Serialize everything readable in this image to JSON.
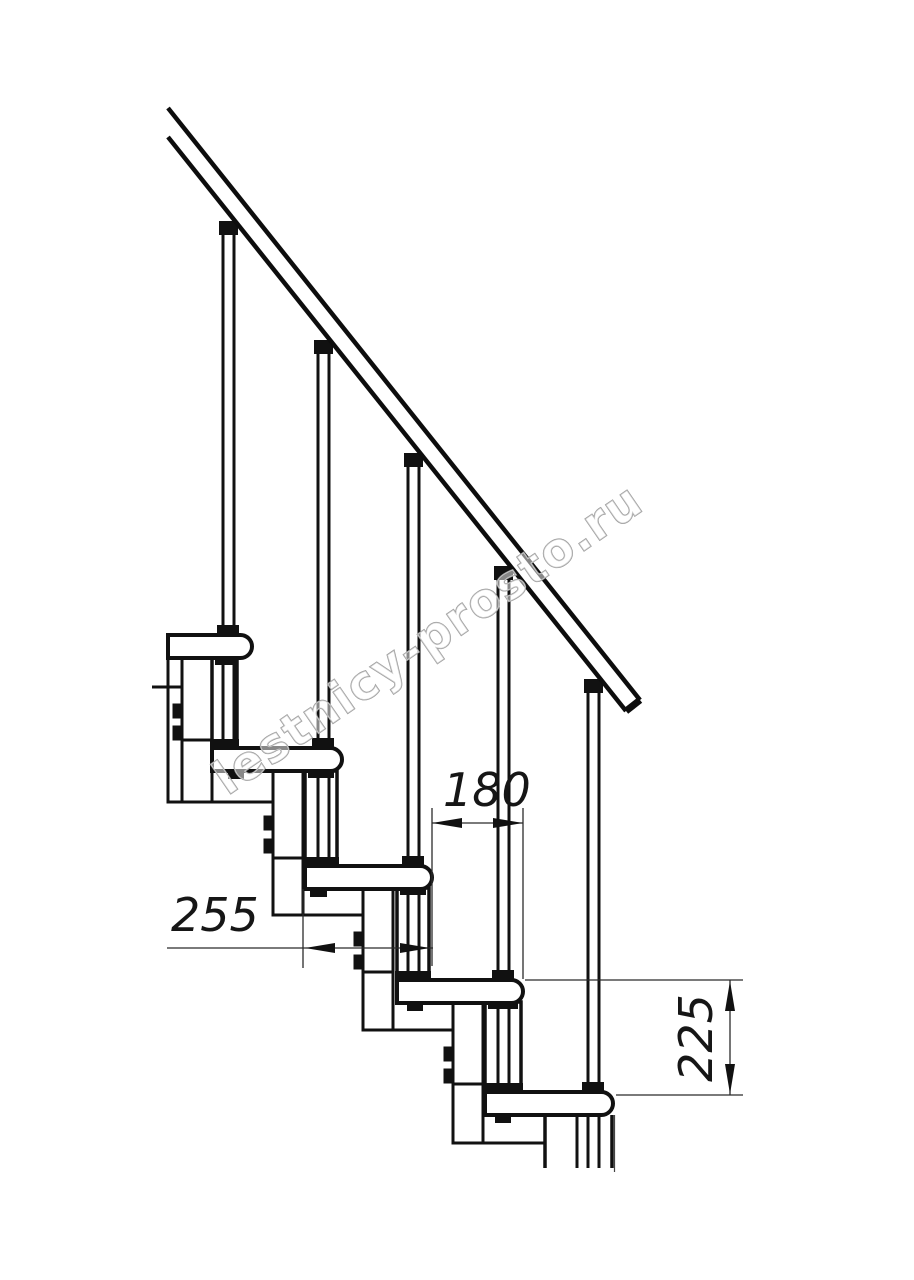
{
  "drawing": {
    "title": "staircase-side-view-technical-drawing",
    "watermark": "lestnicy-prosto.ru",
    "dimensions": {
      "run": "180",
      "tread_length": "255",
      "rise": "225"
    },
    "colors": {
      "ink": "#111111",
      "dim_line": "#2b2b2b",
      "watermark_stroke": "#9c9c9c",
      "background": "#ffffff"
    }
  }
}
